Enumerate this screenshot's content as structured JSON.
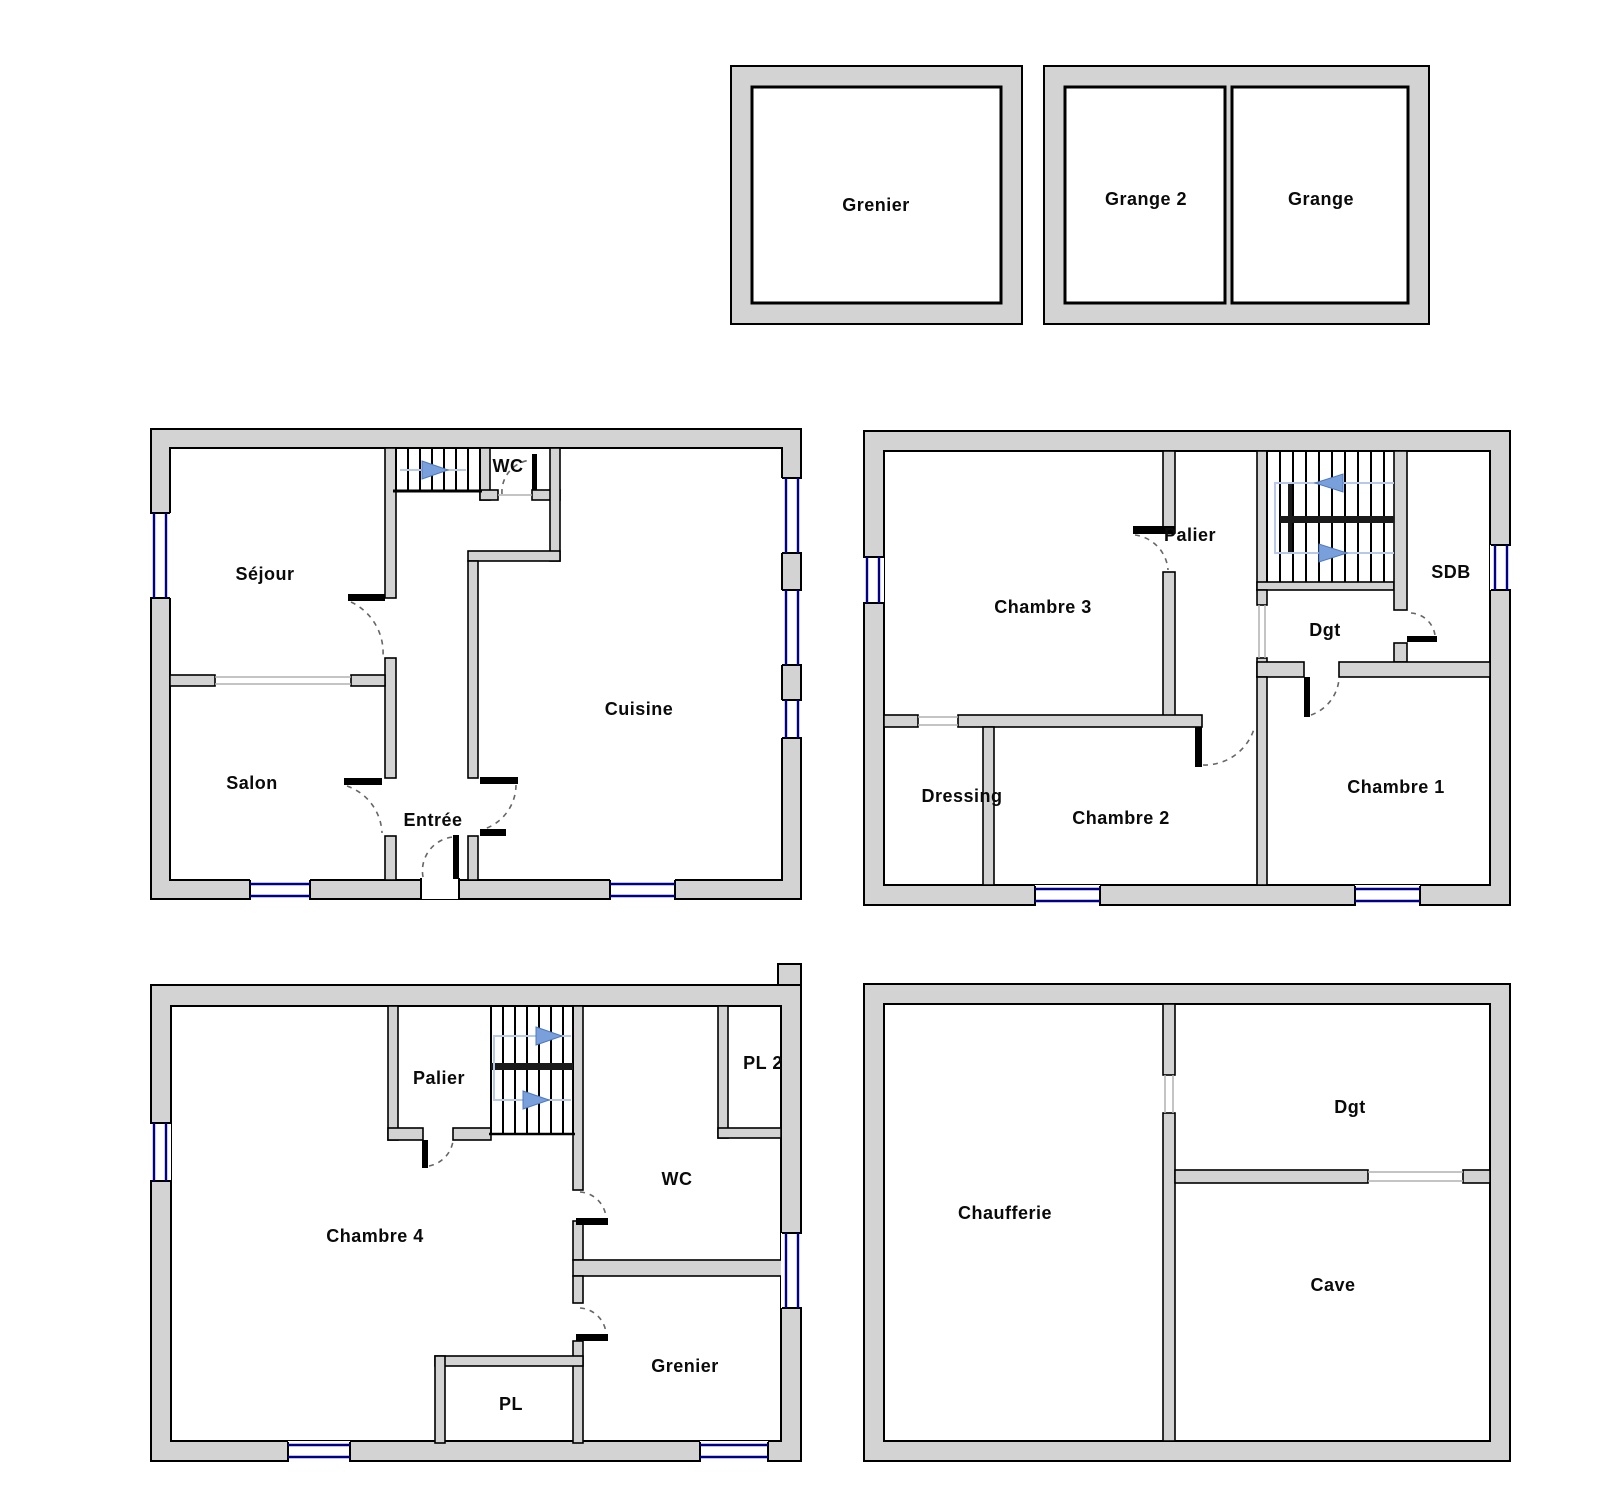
{
  "document": {
    "kind": "house-floor-plans"
  },
  "colors": {
    "wall_fill": "#d3d3d3",
    "wall_stroke": "#000000",
    "window_marker": "#00008b",
    "stair_guide": "#b8c8e8",
    "stair_arrow": "#7aa0dc",
    "label_text": "#0a0a0a",
    "background": "#ffffff"
  },
  "icons": {
    "stair_direction_arrow": "filled triangle",
    "door_swing": "dashed quarter arc",
    "window_marker": "double navy line in wall"
  },
  "plans": {
    "attic_outbuilding": {
      "rooms": {
        "grenier": "Grenier"
      }
    },
    "barn_outbuilding": {
      "rooms": {
        "grange2": "Grange 2",
        "grange": "Grange"
      }
    },
    "ground_floor": {
      "rooms": {
        "sejour": "Séjour",
        "salon": "Salon",
        "cuisine": "Cuisine",
        "entree": "Entrée",
        "wc": "WC"
      }
    },
    "first_floor": {
      "rooms": {
        "chambre3": "Chambre 3",
        "palier": "Palier",
        "sdb": "SDB",
        "dgt": "Dgt",
        "dressing": "Dressing",
        "chambre2": "Chambre 2",
        "chambre1": "Chambre 1"
      }
    },
    "second_floor": {
      "rooms": {
        "palier": "Palier",
        "pl2": "PL 2",
        "wc": "WC",
        "chambre4": "Chambre 4",
        "grenier": "Grenier",
        "pl": "PL"
      }
    },
    "basement": {
      "rooms": {
        "chaufferie": "Chaufferie",
        "dgt": "Dgt",
        "cave": "Cave"
      }
    }
  }
}
